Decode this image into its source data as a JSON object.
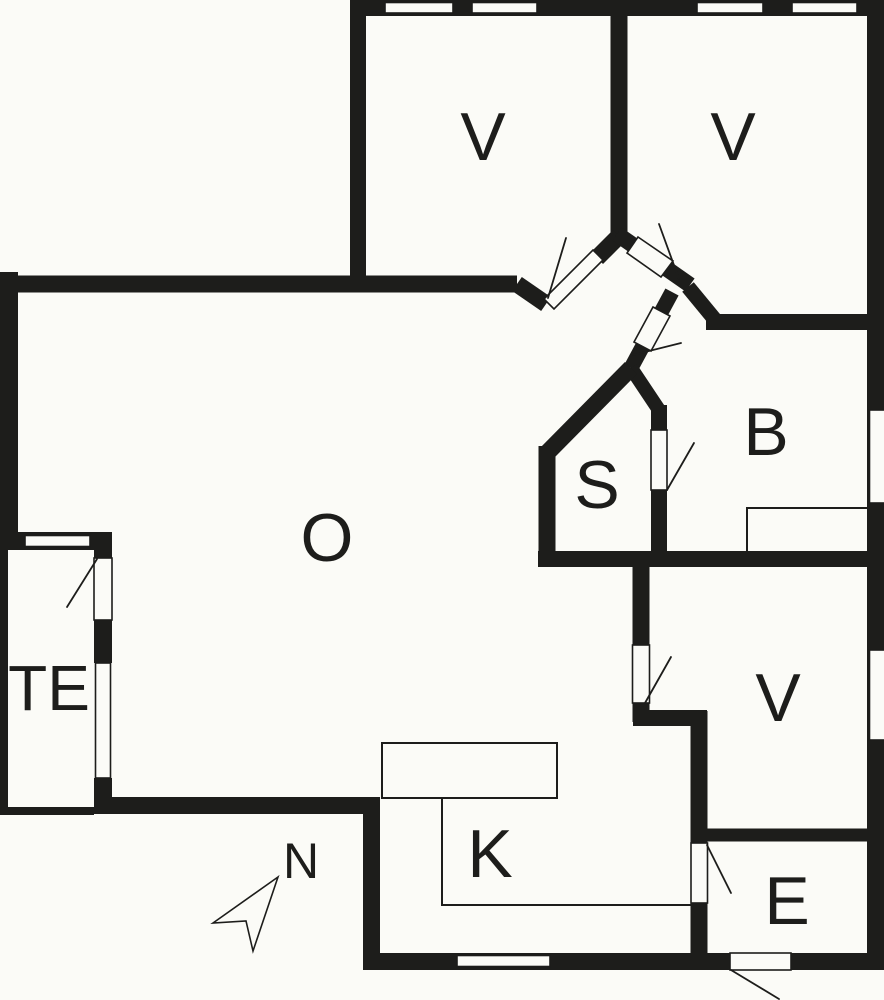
{
  "theme": {
    "wall_color": "#1d1d1b",
    "floor_color": "#fbfbf7",
    "line_color": "#1d1d1b"
  },
  "plan": {
    "rooms": [
      {
        "id": "bedroom-top-left",
        "label": "V"
      },
      {
        "id": "bedroom-top-right",
        "label": "V"
      },
      {
        "id": "bathroom",
        "label": "B"
      },
      {
        "id": "sauna",
        "label": "S"
      },
      {
        "id": "living-room",
        "label": "O"
      },
      {
        "id": "terrace",
        "label": "TE"
      },
      {
        "id": "bedroom-right",
        "label": "V"
      },
      {
        "id": "kitchen",
        "label": "K"
      },
      {
        "id": "entry",
        "label": "E"
      }
    ],
    "compass": {
      "label": "N"
    }
  }
}
